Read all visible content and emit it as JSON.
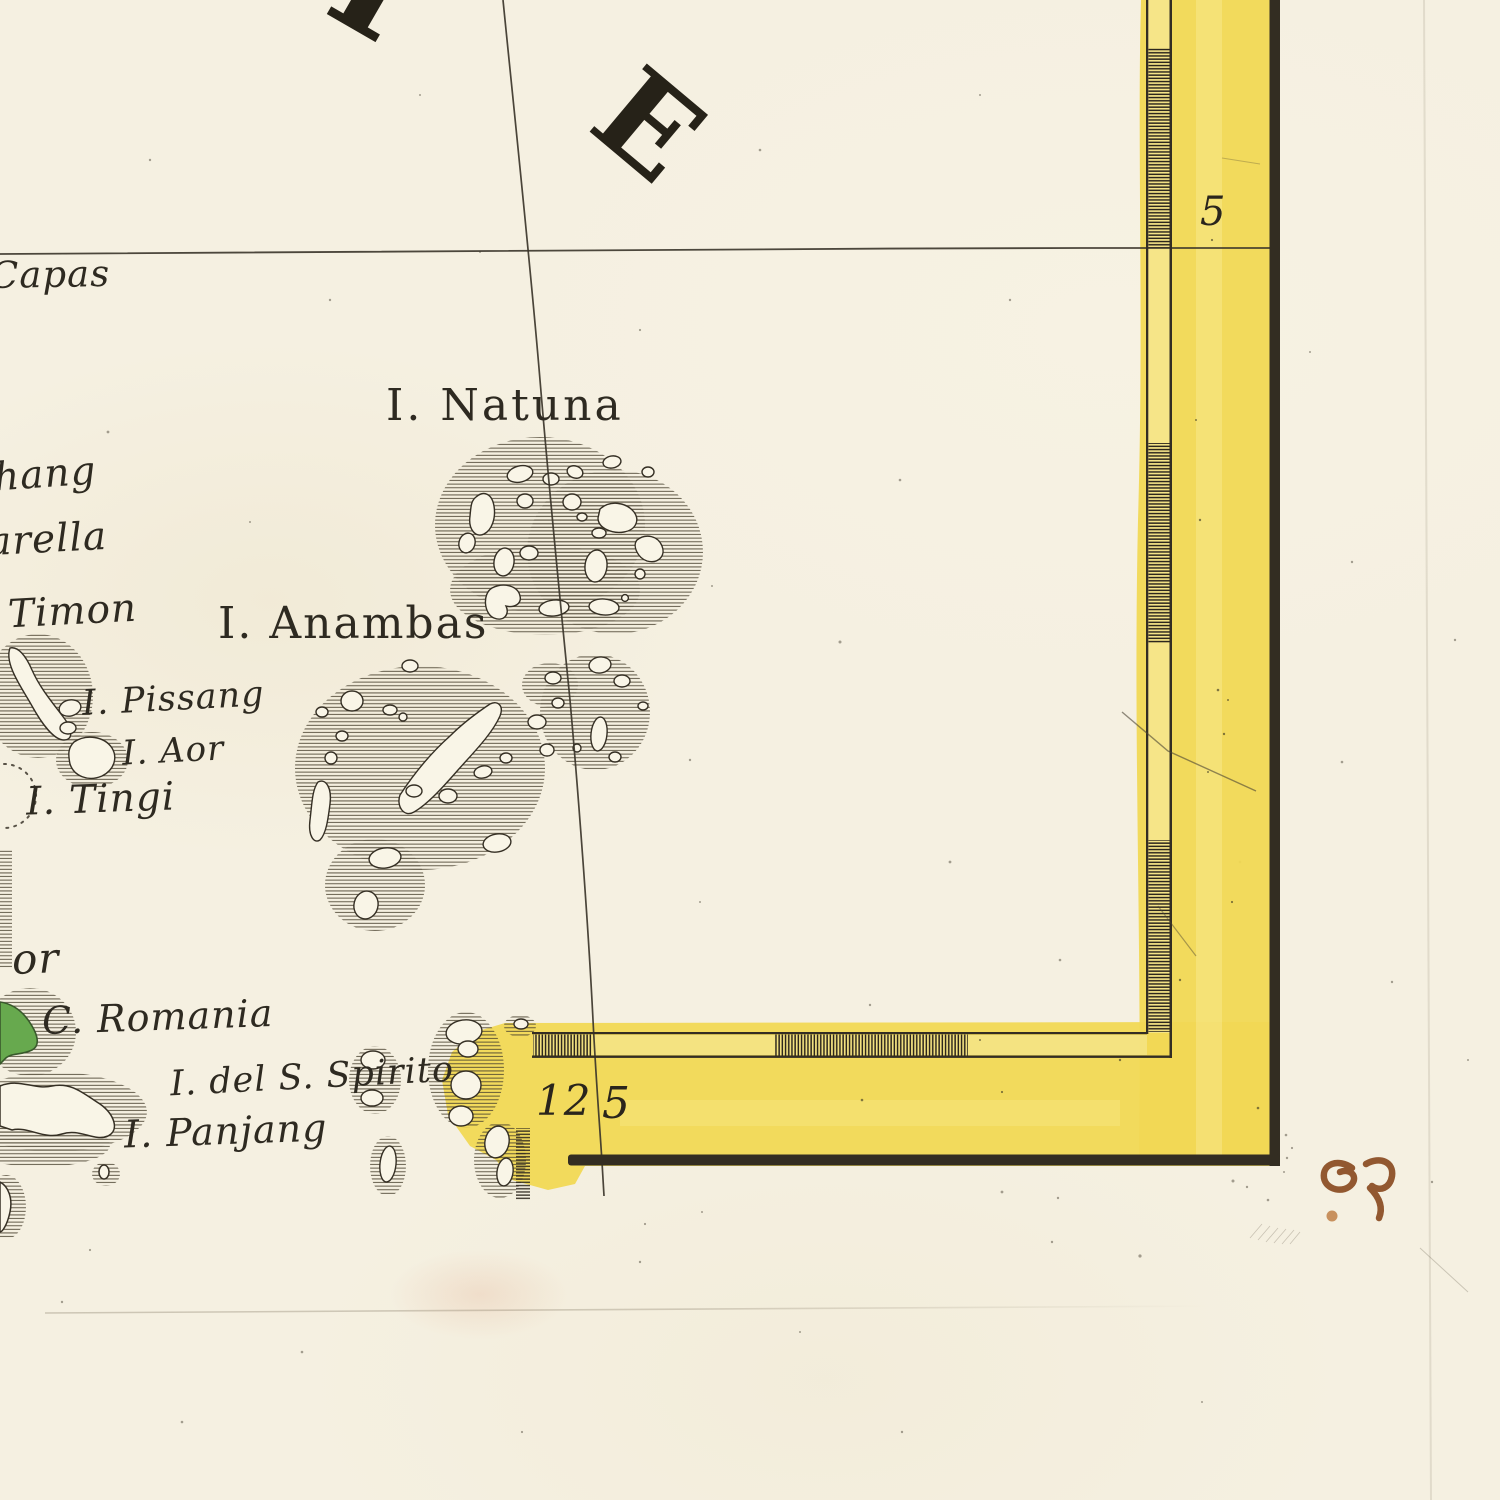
{
  "map": {
    "description": "engraved antique nautical chart detail, South China Sea islands, hand coloured border",
    "sea_title": {
      "letter_i": "I",
      "letter_e": "E"
    },
    "labels": {
      "capas": "Capas",
      "pahang_fragment": "hang",
      "varella_fragment": "arella",
      "timon": "Timon",
      "pissang": "I. Pissang",
      "aor": "I. Aor",
      "tingi": "I. Tingi",
      "johor_fragment": "or",
      "romania": "C. Romania",
      "spirito": "I. del S. Spirito",
      "panjang": "I. Panjang",
      "natuna": "I. Natuna",
      "anambas": "I. Anambas"
    },
    "graticule": {
      "latitude_top": "5",
      "longitude_left": "12",
      "longitude_right": "5"
    }
  },
  "colors": {
    "paper": "#f5f0e1",
    "paper_island": "#f9f5e7",
    "wash_yellow": "#f1d854",
    "wash_light": "#f9ec96",
    "frame_ink": "#332d22",
    "engraving_ink": "#3a342a",
    "island_green": "#67a94e",
    "island_green_dark": "#39592c",
    "manuscript_ink": "#8a4c22",
    "manuscript_dot": "#c08046"
  }
}
